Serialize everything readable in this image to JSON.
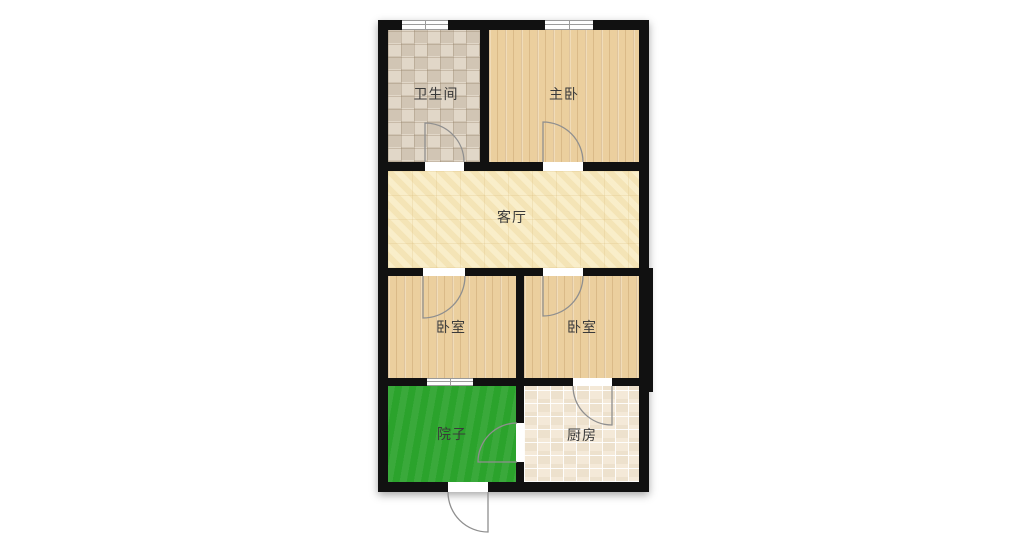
{
  "title": "residential-floor-plan",
  "rooms": [
    {
      "id": "bathroom",
      "label": "卫生间",
      "floor": "checker-tile"
    },
    {
      "id": "master-bedroom",
      "label": "主卧",
      "floor": "wood-plank"
    },
    {
      "id": "living-room",
      "label": "客厅",
      "floor": "pale-yellow"
    },
    {
      "id": "bedroom-left",
      "label": "卧室",
      "floor": "wood-plank"
    },
    {
      "id": "bedroom-right",
      "label": "卧室",
      "floor": "wood-plank"
    },
    {
      "id": "yard",
      "label": "院子",
      "floor": "grass-green"
    },
    {
      "id": "kitchen",
      "label": "厨房",
      "floor": "light-tile"
    }
  ],
  "doors": [
    "bathroom-door",
    "master-bedroom-door",
    "bedroom-left-door",
    "bedroom-right-door",
    "kitchen-door",
    "yard-kitchen-door",
    "yard-exterior-door"
  ],
  "windows": [
    "bathroom-north-window",
    "master-bedroom-north-window",
    "bedroom-left-yard-window"
  ],
  "colors": {
    "wall": "#111111",
    "wood_floor": "#ebcf9e",
    "living_floor": "#f4e4b6",
    "yard_green": "#2ba32c",
    "kitchen_tile": "#f2e7d5",
    "bathroom_tile": "#d9cebe",
    "door_arc": "#8f8f8f",
    "window_line": "#9a9a9a",
    "label_text": "#3a3a3a"
  }
}
